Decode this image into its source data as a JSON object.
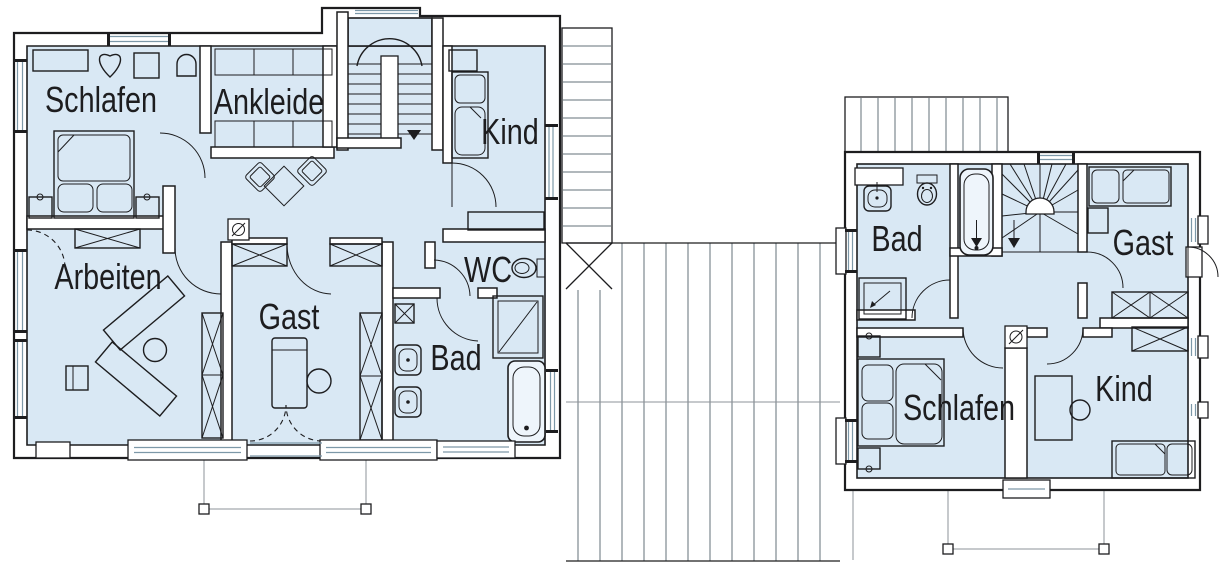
{
  "palette": {
    "room_fill": "#d9e8f4",
    "wall_fill": "#ffffff",
    "line": "#1d1d1f",
    "hatch": "#63707a",
    "glass": "#7d98a8",
    "thin": "#8e9398"
  },
  "left_plan": {
    "rooms": [
      {
        "id": "schlafen",
        "label": "Schlafen"
      },
      {
        "id": "ankleide",
        "label": "Ankleide"
      },
      {
        "id": "kind",
        "label": "Kind"
      },
      {
        "id": "arbeiten",
        "label": "Arbeiten"
      },
      {
        "id": "gast",
        "label": "Gast"
      },
      {
        "id": "wc",
        "label": "WC"
      },
      {
        "id": "bad",
        "label": "Bad"
      }
    ]
  },
  "right_plan": {
    "rooms": [
      {
        "id": "bad",
        "label": "Bad"
      },
      {
        "id": "gast",
        "label": "Gast"
      },
      {
        "id": "schlafen",
        "label": "Schlafen"
      },
      {
        "id": "kind",
        "label": "Kind"
      }
    ]
  },
  "icons": {
    "chimney": "circle-with-slash",
    "toilet": "wc-pan",
    "shower": "shower-tray-with-arrow",
    "bathtub": "tub-with-arrow",
    "sink": "washbasin",
    "washer": "crossed-square",
    "stair_direction": "down-arrow"
  }
}
